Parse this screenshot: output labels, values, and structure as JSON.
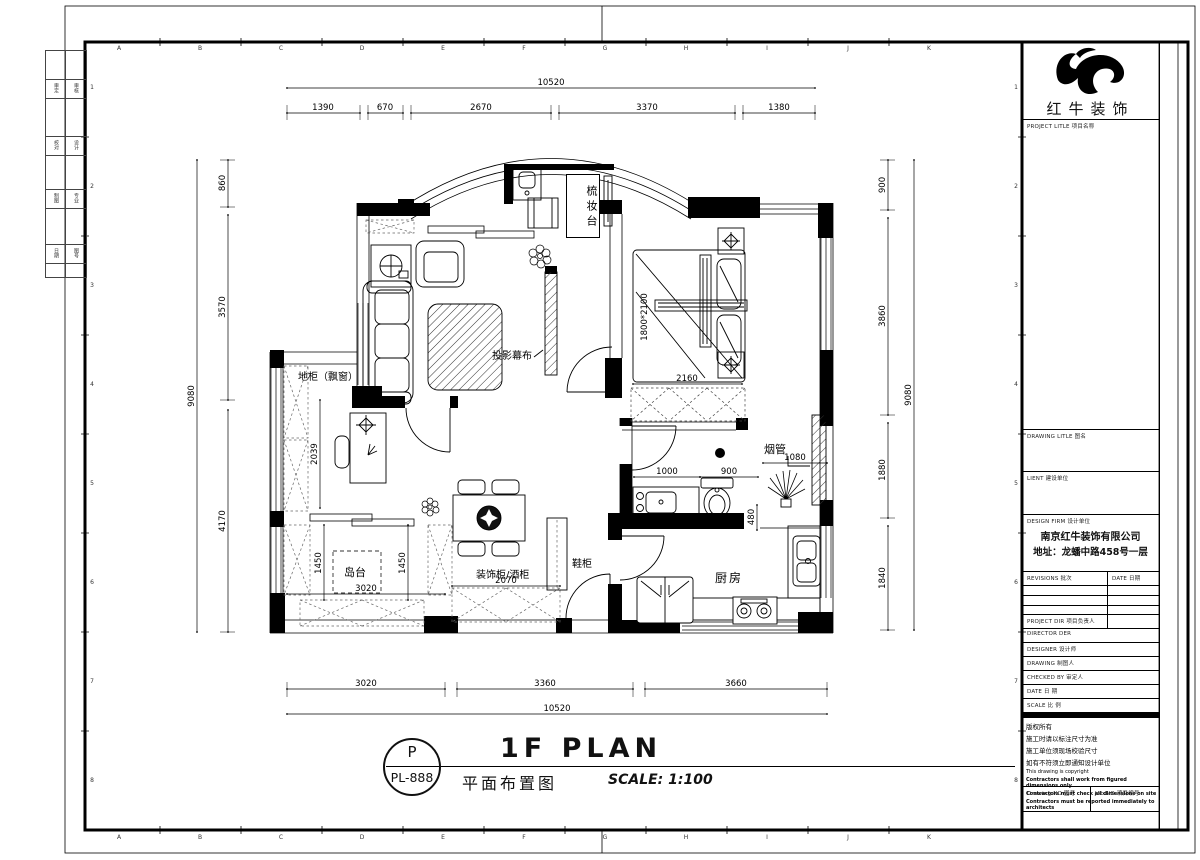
{
  "sheet": {
    "grid_letters": [
      "A",
      "B",
      "C",
      "D",
      "E",
      "F",
      "G",
      "H",
      "I",
      "J",
      "K"
    ],
    "grid_numbers": [
      "1",
      "2",
      "3",
      "4",
      "5",
      "6",
      "7",
      "8"
    ],
    "stamp_rows": [
      [
        "审定",
        "审核"
      ],
      [
        "校对",
        "设计"
      ],
      [
        "制图",
        "专业"
      ],
      [
        "日期",
        "图号"
      ]
    ]
  },
  "plan": {
    "labels": {
      "dressing_table": "梳妆台",
      "projection_screen": "投影幕布",
      "window_cabinet": "地柜（飘窗）",
      "island": "岛台",
      "deco_wine_cabinet": "装饰柜/酒柜",
      "shoe_cabinet": "鞋柜",
      "kitchen": "厨房",
      "flue": "烟管",
      "bed_size": "1800*2100"
    },
    "dims": {
      "top_total": "10520",
      "top_seg": [
        "1390",
        "670",
        "2670",
        "3370",
        "1380"
      ],
      "bottom_seg": [
        "3020",
        "3360",
        "3660"
      ],
      "bottom_total": "10520",
      "left_seg": [
        "860",
        "3570",
        "4170"
      ],
      "left_total": "9080",
      "right_seg": [
        "900",
        "3860",
        "1880",
        "1840"
      ],
      "right_total": "9080",
      "wardrobe": "2160",
      "study": "2039",
      "island_left": "1450",
      "island_right": "1450",
      "island_width": "3020",
      "deco_cabinet": "2070",
      "bath_a": "1000",
      "bath_b": "900",
      "flue_w": "1080",
      "pass": "480"
    }
  },
  "title_area": {
    "tag_letter": "P",
    "tag_number": "PL-888",
    "title_en": "1F PLAN",
    "title_cn": "平面布置图",
    "scale": "SCALE: 1:100"
  },
  "title_block": {
    "brand": "红牛装饰",
    "project_title": "PROJECT LITLE 项目名称",
    "drawing_title": "DRAWING LITLE 图名",
    "client": "LIENT 建设单位",
    "design_firm": "DESIGN FIRM 设计单位",
    "firm_name": "南京红牛装饰有限公司",
    "firm_addr": "地址：龙蟠中路458号一层",
    "revisions": "REVISIONS 批次",
    "date_col": "DATE 日期",
    "rows": [
      "PROJECT DIR 项目负责人",
      "DIRECTOR DER",
      "DESIGNER 设计师",
      "DRAWING 制图人",
      "CHECKED BY 审定人",
      "DATE 日 期",
      "SCALE 比 例"
    ],
    "copyright": [
      "版权所有",
      "施工时请以标注尺寸为准",
      "施工单位须现场校验尺寸",
      "如有不符须立即通知设计单位",
      "This drawing is copyright"
    ],
    "copyright_bold": [
      "Contractors shall work from figured dimensions only",
      "Contractors must check all dimensions on site",
      "Contractors must be reported immediately to architects"
    ],
    "drawing_no": "Drawing NO 图号",
    "job_no": "Job NO 项目编号"
  }
}
